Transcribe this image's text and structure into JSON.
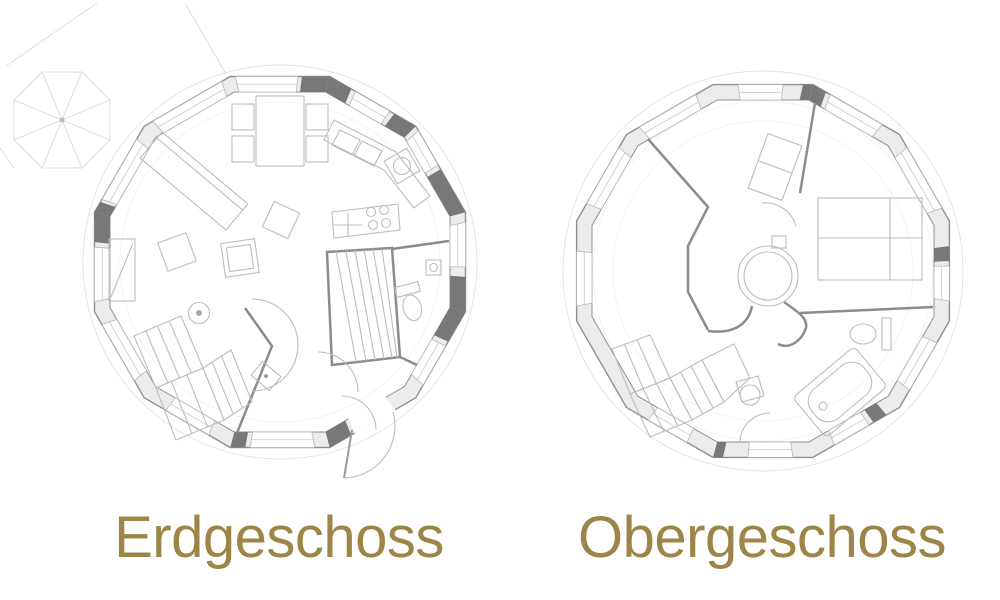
{
  "captions": {
    "left": "Erdgeschoss",
    "right": "Obergeschoss"
  },
  "colors": {
    "caption": "#9c8546",
    "background": "#ffffff",
    "wall_line": "#8c8c8c",
    "furniture_line": "#bdbdbd",
    "window_line": "#b8b8b8",
    "dark_wall": "#787878"
  }
}
